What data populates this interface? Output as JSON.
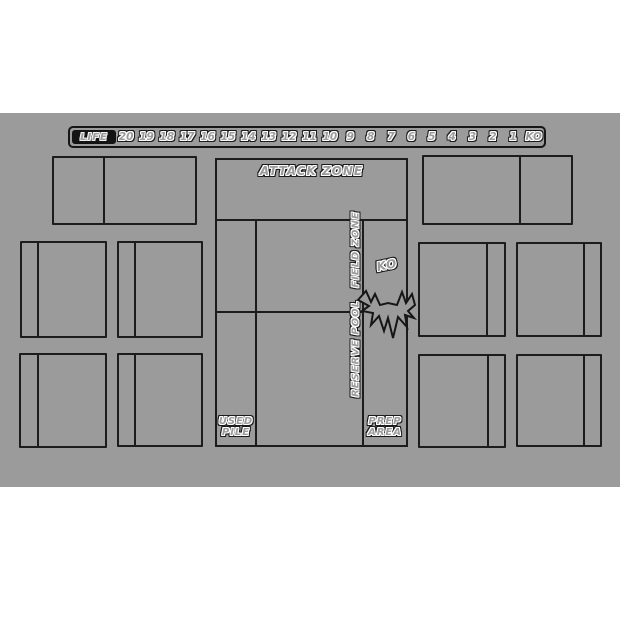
{
  "mat": {
    "bg_color": "#9b9b9b",
    "line_color": "#1c1c1c",
    "page_bg": "#ffffff",
    "life_tracker": {
      "label": "LIFE",
      "values": [
        "20",
        "19",
        "18",
        "17",
        "16",
        "15",
        "14",
        "13",
        "12",
        "11",
        "10",
        "9",
        "8",
        "7",
        "6",
        "5",
        "4",
        "3",
        "2",
        "1",
        "KO"
      ]
    },
    "zones": {
      "attack": "ATTACK ZONE",
      "field": "FIELD ZONE",
      "reserve": "RESERVE POOL",
      "ko": "KO",
      "used_line1": "USED",
      "used_line2": "PILE",
      "prep_line1": "PREP",
      "prep_line2": "AREA"
    }
  }
}
